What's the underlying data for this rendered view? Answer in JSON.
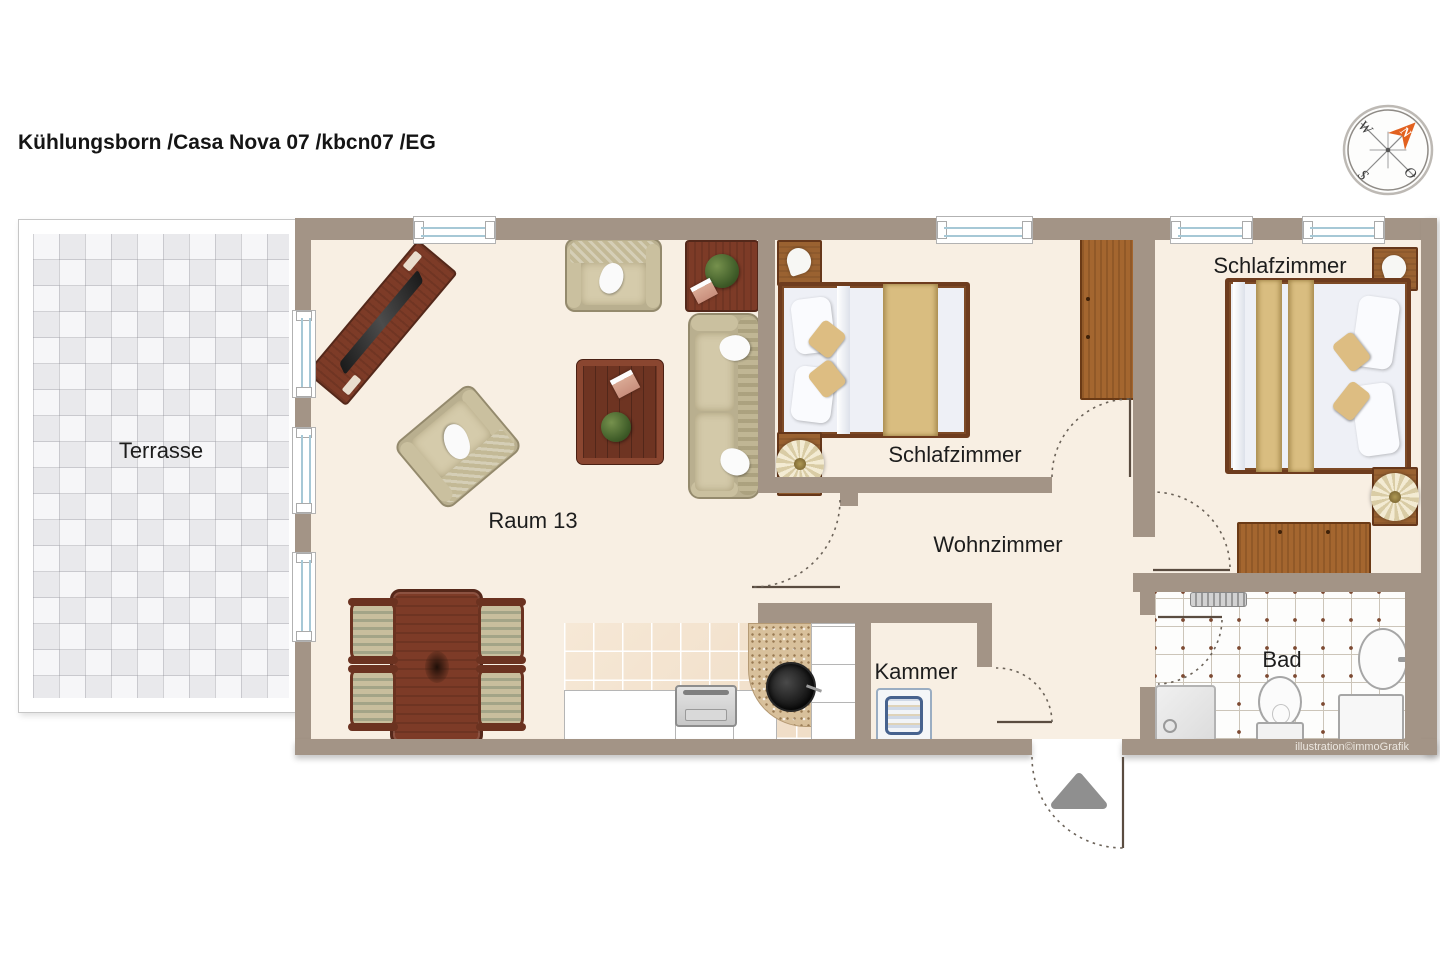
{
  "title": "Kühlungsborn /Casa Nova 07 /kbcn07 /EG",
  "attribution": "illustration©immoGrafik",
  "compass": {
    "north": "N",
    "east": "O",
    "south": "S",
    "west": "W"
  },
  "rooms": {
    "terrasse": {
      "label": "Terrasse"
    },
    "raum13": {
      "label": "Raum 13"
    },
    "schlafzimmer1": {
      "label": "Schlafzimmer"
    },
    "schlafzimmer2": {
      "label": "Schlafzimmer"
    },
    "wohnzimmer": {
      "label": "Wohnzimmer"
    },
    "kammer": {
      "label": "Kammer"
    },
    "bad": {
      "label": "Bad"
    }
  },
  "colors": {
    "wall": "#a39486",
    "floor": "#f8efe3",
    "terrace_tile": "#e9e9ec",
    "wood_dark": "#7d3b27",
    "wood_mid": "#a4662f",
    "upholstery": "#c3b996",
    "bed_runner": "#d9bd80",
    "compass_needle": "#e2611f",
    "window_glass": "#a6c8d6"
  }
}
